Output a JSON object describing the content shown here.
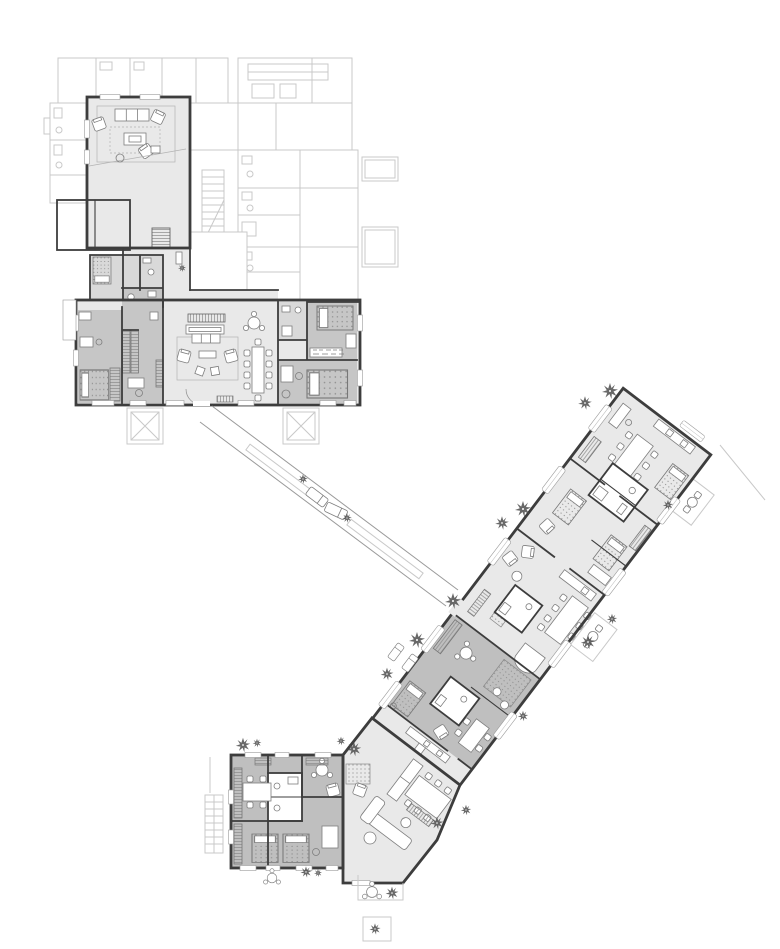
{
  "canvas": {
    "width": 780,
    "height": 949,
    "background": "#ffffff"
  },
  "palette": {
    "wall": "#3d3d3d",
    "line": "#7e7e7e",
    "line_light": "#b3b3b3",
    "context": "#c9c9c9",
    "fill_light": "#e9e9e9",
    "fill_mid": "#d9d9d9",
    "fill_dark": "#c6c6c6",
    "fill_darker": "#bfbfbf",
    "tree": "#4d4d4d",
    "background": "#ffffff"
  },
  "plan": {
    "kind": "architectural-floor-plan",
    "areas": [
      {
        "id": "context-neighbour-buildings"
      },
      {
        "id": "north-building"
      },
      {
        "id": "skylight-planters"
      },
      {
        "id": "garden-walkway"
      },
      {
        "id": "diagonal-wing"
      },
      {
        "id": "dark-apartment-wing"
      },
      {
        "id": "south-building"
      },
      {
        "id": "terraces"
      }
    ]
  },
  "trees": [
    {
      "x": 610,
      "y": 391,
      "s": 1.0
    },
    {
      "x": 585,
      "y": 403,
      "s": 0.85
    },
    {
      "x": 523,
      "y": 509,
      "s": 1.0
    },
    {
      "x": 502,
      "y": 523,
      "s": 0.85
    },
    {
      "x": 453,
      "y": 601,
      "s": 1.0
    },
    {
      "x": 417,
      "y": 640,
      "s": 1.0
    },
    {
      "x": 387,
      "y": 674,
      "s": 0.8
    },
    {
      "x": 668,
      "y": 505,
      "s": 0.65
    },
    {
      "x": 612,
      "y": 619,
      "s": 0.65
    },
    {
      "x": 588,
      "y": 642,
      "s": 0.9
    },
    {
      "x": 523,
      "y": 716,
      "s": 0.65
    },
    {
      "x": 466,
      "y": 810,
      "s": 0.65
    },
    {
      "x": 437,
      "y": 823,
      "s": 0.8
    },
    {
      "x": 243,
      "y": 745,
      "s": 0.9
    },
    {
      "x": 257,
      "y": 743,
      "s": 0.55
    },
    {
      "x": 341,
      "y": 741,
      "s": 0.55
    },
    {
      "x": 354,
      "y": 749,
      "s": 0.9
    },
    {
      "x": 303,
      "y": 479,
      "s": 0.6
    },
    {
      "x": 347,
      "y": 518,
      "s": 0.6
    },
    {
      "x": 306,
      "y": 872,
      "s": 0.7
    },
    {
      "x": 318,
      "y": 873,
      "s": 0.5
    },
    {
      "x": 392,
      "y": 893,
      "s": 0.8
    },
    {
      "x": 375,
      "y": 929,
      "s": 0.7
    },
    {
      "x": 182,
      "y": 268,
      "s": 0.5
    }
  ]
}
